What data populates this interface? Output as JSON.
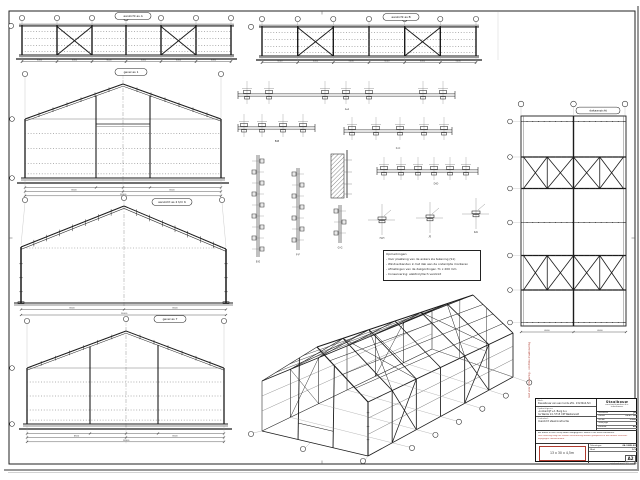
{
  "page": {
    "paper": "#ffffff",
    "line_color": "#1b1b1b",
    "accent_red": "#b03a2e"
  },
  "titles": {
    "elevation_a": "aanzicht as A",
    "elevation_b": "aanzicht as B",
    "gable_front": "gevel as 1",
    "portal_frames": "aanzicht as 2 t/m 6",
    "gable_rear": "gevel as 7",
    "roof_plan": "dakaanzicht"
  },
  "detail_labels": {
    "aa": "A-A",
    "bb": "B-B",
    "cc": "C-C",
    "dd": "D-D",
    "ee": "E-E",
    "ff": "F-F",
    "gg": "G-G",
    "hh": "H-H",
    "jj": "J-J",
    "kk": "K-K"
  },
  "dims": {
    "bay": "5000",
    "half_span": "6500",
    "span": "13000",
    "length": "30000",
    "height": "4500"
  },
  "notes": {
    "heading": "Opmerkingen:",
    "items": [
      "- Voor plaatsing van de ankers zie tekening (S1)",
      "- Windverbanden in het dak aan de onderzijde monteren",
      "- Afmetingen van de dakgordingen 71 x 200 mm",
      "- Conservering: elektrolytisch verzinkt"
    ]
  },
  "title_block": {
    "work_label": "Werk:",
    "work_value": "Nieuwbouw van een loods afm. 13x30x4,5m",
    "client_label": "Opdrachtgever:",
    "client_line1": "Loonbedrijf v.d. Berg b.v.",
    "client_line2": "De Weide 14, 5715 CM Westerveld",
    "part_label": "Onderdeel:",
    "part_value": "Overzicht staalconstructie",
    "company": {
      "line1": "Staalbouw",
      "line2": "constructiewerken b.v.",
      "line3": "tekenkamer"
    },
    "fields": [
      {
        "label": "Getekend",
        "value": "JR"
      },
      {
        "label": "Datum",
        "value": "12-07-'04"
      },
      {
        "label": "Schaal",
        "value": "1:100"
      },
      {
        "label": "Gewijzigd",
        "value": "-"
      },
      {
        "label": "Formaat",
        "value": "A2"
      }
    ],
    "disclaimer0": "Alle maten in mm, tenzij anders aangegeven. Maten in het werk controleren.",
    "disclaimer1": "Deze tekening mag niet zonder toestemming worden gekopieerd of aan derden verstrekt.",
    "disclaimer2": "Wijzigingen voorbehouden.",
    "size_box": "13 x 30 x 4,5m",
    "drawing_no_label": "Tekeningnr.",
    "drawing_no": "04-1185-S2",
    "sheet_label": "Blad",
    "sheet_no": "1/1",
    "format": "A2",
    "footer": "getekend met CAD - wijz. 0"
  },
  "stamp": {
    "text": "niet voor uitvoering - controle maatvoering"
  }
}
